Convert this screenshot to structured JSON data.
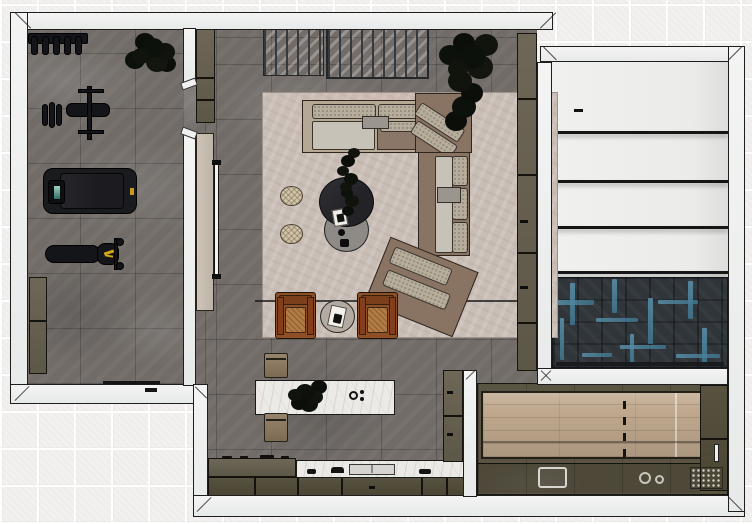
{
  "scene": {
    "title": "Top-down 3D rendered floor plan",
    "background": "light ceramic tile grid",
    "rooms": [
      {
        "id": "gym",
        "label": "Home gym",
        "floor": "dark gray stone tile"
      },
      {
        "id": "living-room",
        "label": "Living room",
        "floor": "dark gray stone tile with beige area rug"
      },
      {
        "id": "kitchen",
        "label": "Kitchen",
        "floor": "dark gray stone tile"
      },
      {
        "id": "stair-room",
        "label": "Wide white stepped area",
        "floor": "blue herringbone parquet landing"
      },
      {
        "id": "games-room",
        "label": "Bar / shuffleboard room",
        "floor": "oak shuffleboard lane with counters"
      }
    ],
    "furniture": {
      "gym": [
        {
          "id": "dumbbell-rack",
          "label": "Dumbbell rack"
        },
        {
          "id": "gym-plant",
          "label": "Potted plant"
        },
        {
          "id": "bench-press",
          "label": "Bench press station"
        },
        {
          "id": "treadmill",
          "label": "Treadmill"
        },
        {
          "id": "weight-bench",
          "label": "Weight bench"
        },
        {
          "id": "gym-cabinet",
          "label": "Storage cabinet"
        }
      ],
      "living_room": [
        {
          "id": "glass-partition",
          "label": "Glass partition panels"
        },
        {
          "id": "tall-cabinet-left",
          "label": "Tall cabinet"
        },
        {
          "id": "sliding-door",
          "label": "Sliding door panel"
        },
        {
          "id": "tall-cabinet-right",
          "label": "Wall cabinet column"
        },
        {
          "id": "floor-plant",
          "label": "Tall floor plant"
        },
        {
          "id": "area-rug",
          "label": "Area rug"
        },
        {
          "id": "sectional-sofa",
          "label": "Curved sectional sofa"
        },
        {
          "id": "coffee-table",
          "label": "Round dark coffee table with plant"
        },
        {
          "id": "nesting-table",
          "label": "Round gray nesting table"
        },
        {
          "id": "pouf",
          "label": "Round woven pouf"
        },
        {
          "id": "armchair",
          "label": "Cognac leather armchair"
        },
        {
          "id": "side-table",
          "label": "Round side table with book"
        }
      ],
      "kitchen": [
        {
          "id": "island",
          "label": "Marble kitchen island"
        },
        {
          "id": "island-bench",
          "label": "Island bench"
        },
        {
          "id": "cooktop-counter",
          "label": "Counter with cooktop knobs"
        },
        {
          "id": "sink-counter",
          "label": "Marble counter with sink"
        },
        {
          "id": "base-cabinets",
          "label": "Base cabinet row"
        },
        {
          "id": "pantry-column",
          "label": "Pantry cabinet column"
        }
      ],
      "games_room": [
        {
          "id": "shuffleboard",
          "label": "Shuffleboard lane with foul line"
        },
        {
          "id": "bar-counter",
          "label": "Bar counter with accessories"
        },
        {
          "id": "bar-column",
          "label": "Bar cabinet column"
        }
      ],
      "stair_room": [
        {
          "id": "white-steps",
          "label": "Wide white steps"
        },
        {
          "id": "herringbone-floor",
          "label": "Blue herringbone parquet"
        }
      ]
    },
    "palette": {
      "background_tile": "#f2f1ef",
      "wall": "#eef0ef",
      "wall_outline": "#1e1e1e",
      "dark_floor": "#716c68",
      "rug": "#c9beb6",
      "olive_cabinet": "#6a6454",
      "marble": "#eceae6",
      "wood_lane": "#c0a98e",
      "herringbone_base": "#30353a",
      "herringbone_accent": "#4e8aa6",
      "sofa_cushion": "#b7ad9c",
      "sofa_base": "#897463",
      "leather_chair": "#9a5a2e",
      "equipment_black": "#141518",
      "accent_yellow": "#d3a616"
    }
  }
}
